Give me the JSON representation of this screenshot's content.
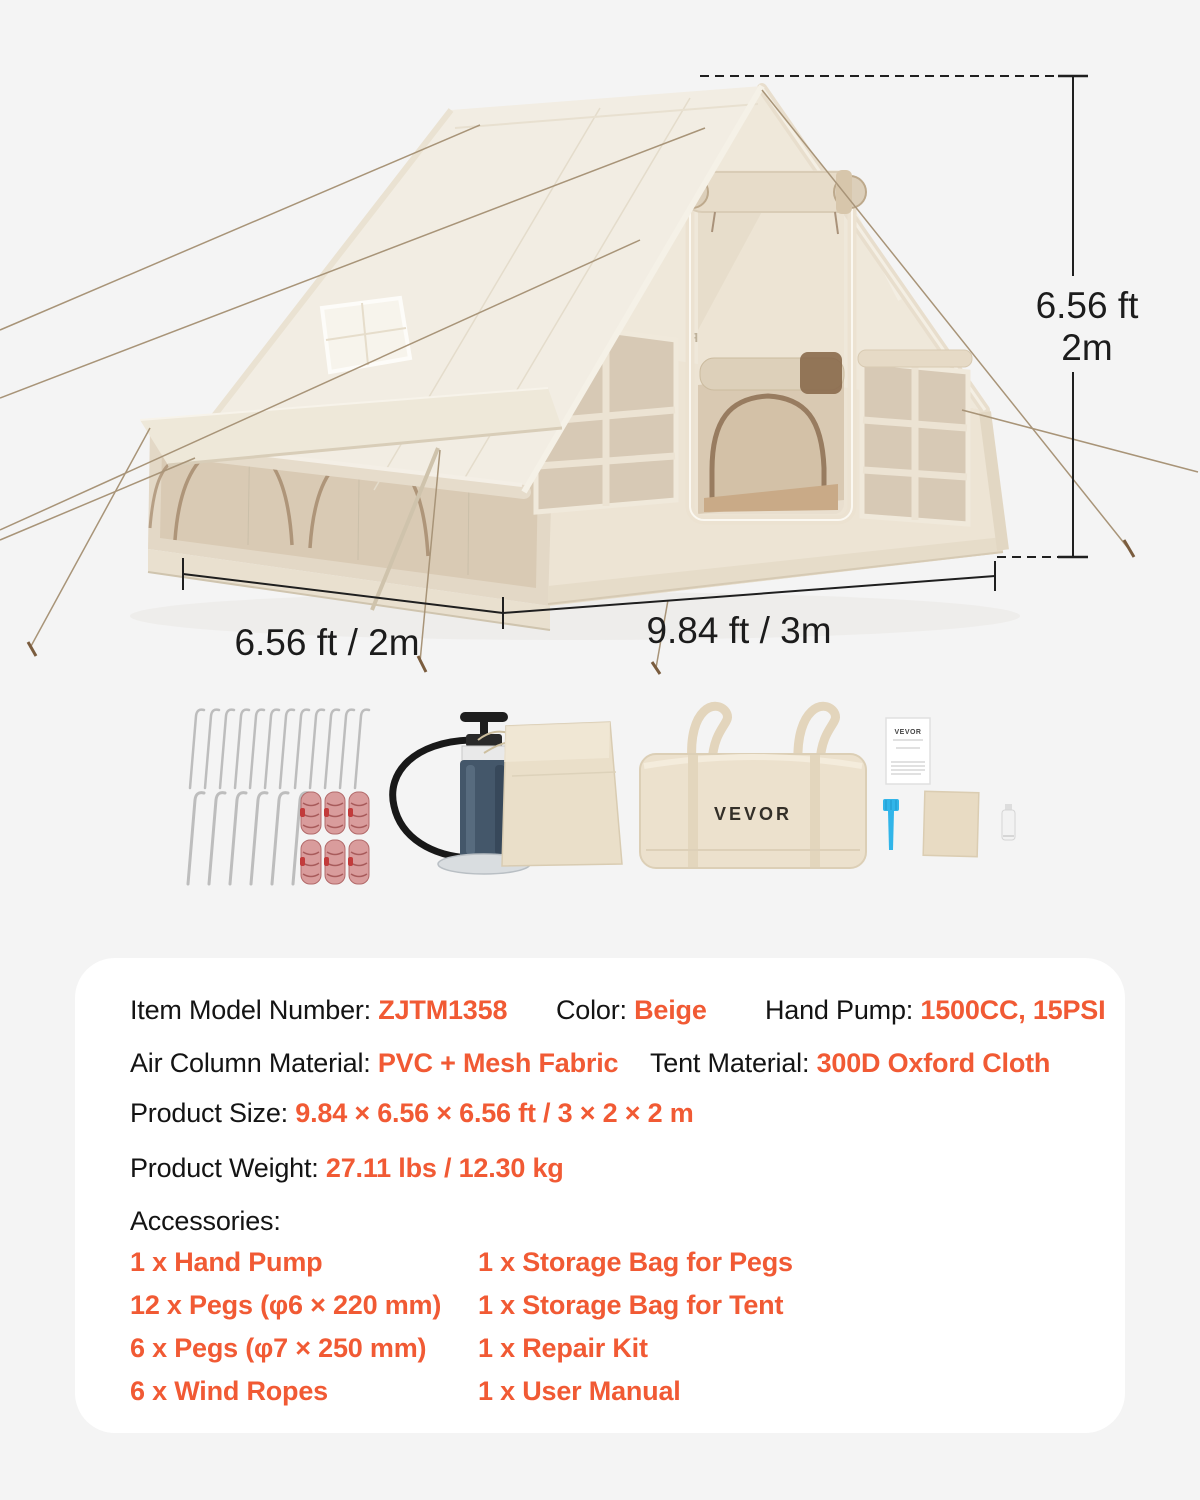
{
  "colors": {
    "background": "#f4f4f4",
    "panel": "#ffffff",
    "accent_orange": "#f15a34",
    "ink": "#141414",
    "dimension_line": "#1f1f1f",
    "tent_cream": "#f1ece1",
    "tent_mesh": "#d8cab6",
    "trim_brown": "#8f7155"
  },
  "dimensions": {
    "height_ft": "6.56 ft",
    "height_m": "2m",
    "width_label": "6.56 ft / 2m",
    "length_label": "9.84 ft / 3m"
  },
  "branding": {
    "tent_logo": "VEVOR",
    "bag_logo": "VEVOR",
    "manual_logo": "VEVOR"
  },
  "specs": {
    "model": {
      "label": "Item Model Number: ",
      "value": "ZJTM1358"
    },
    "color": {
      "label": "Color: ",
      "value": "Beige"
    },
    "hand_pump": {
      "label": "Hand Pump: ",
      "value": "1500CC, 15PSI"
    },
    "air_column": {
      "label": "Air Column Material: ",
      "value": "PVC + Mesh Fabric"
    },
    "tent_material": {
      "label": "Tent Material: ",
      "value": "300D Oxford Cloth"
    },
    "product_size": {
      "label": "Product Size: ",
      "value": "9.84 × 6.56 × 6.56 ft / 3 × 2 × 2 m"
    },
    "product_weight": {
      "label": "Product Weight: ",
      "value": "27.11 lbs / 12.30 kg"
    },
    "accessories_title": "Accessories:",
    "accessories_col1": [
      "1 x Hand Pump",
      "12 x Pegs (φ6 × 220 mm)",
      "6 x Pegs (φ7 × 250 mm)",
      "6 x Wind Ropes"
    ],
    "accessories_col2": [
      "1 x Storage Bag for Pegs",
      "1 x Storage Bag for Tent",
      "1 x Repair Kit",
      "1 x User Manual"
    ]
  }
}
